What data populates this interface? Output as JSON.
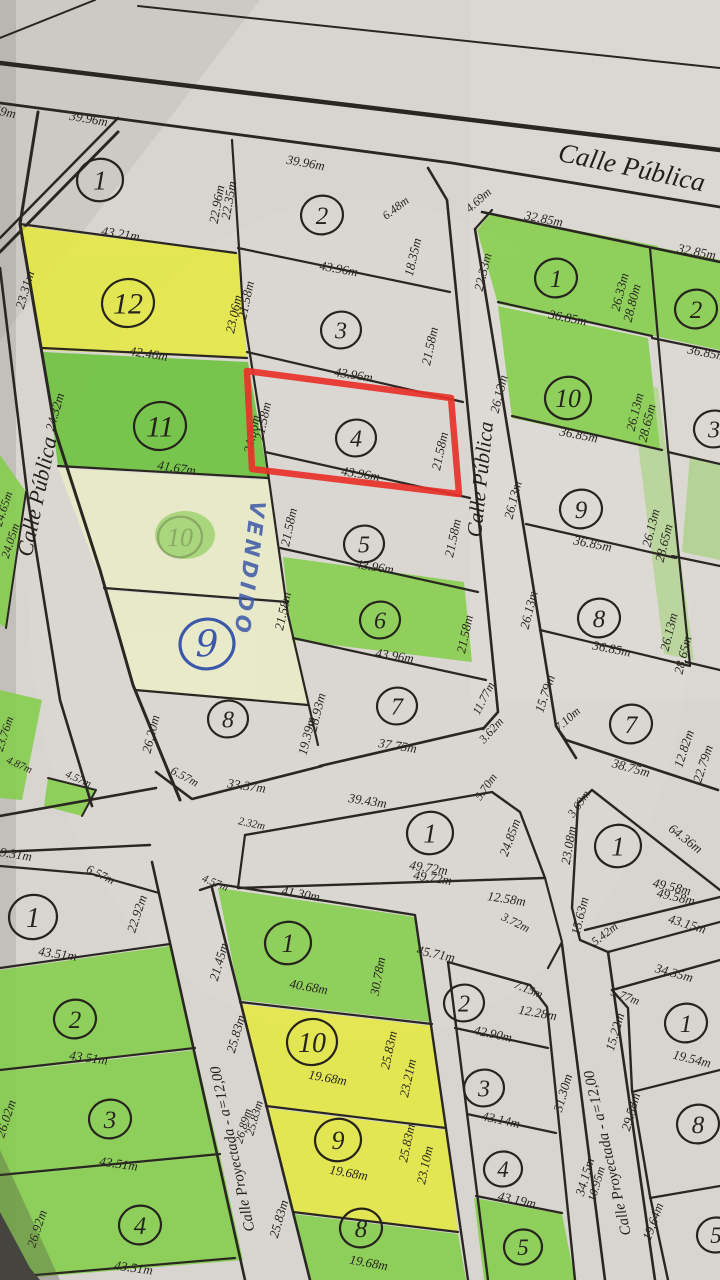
{
  "colors": {
    "paper": "#d8d5d0",
    "ink": "#28251f",
    "highlight_green": "#82ce47",
    "highlight_green_dark": "#68c236",
    "highlight_cream": "#eaedc8",
    "highlight_yellow": "#e6e93e",
    "annotation_red": "#e8322a",
    "handwriting_blue": "#3c58a9"
  },
  "annotations": {
    "vendido": "VENDIDO",
    "selected_lot": "4"
  },
  "streets": [
    [
      "Calle Pública",
      630,
      176,
      12,
      27
    ],
    [
      "Calle Pública",
      44,
      498,
      -78,
      22
    ],
    [
      "Calle Pública",
      487,
      480,
      -84,
      21
    ],
    [
      "Calle Proyectada - a=12,00",
      237,
      1148,
      -102,
      15
    ],
    [
      "Calle Proyectada - a=12,00",
      612,
      1152,
      -103,
      15
    ]
  ],
  "lot_numbers": [
    [
      "1",
      100,
      180,
      23,
      27,
      ""
    ],
    [
      "12",
      128,
      303,
      26,
      30,
      ""
    ],
    [
      "11",
      160,
      426,
      26,
      30,
      ""
    ],
    [
      "10",
      180,
      537,
      22,
      26,
      "faded"
    ],
    [
      "8",
      228,
      719,
      20,
      24,
      ""
    ],
    [
      "2",
      322,
      215,
      21,
      25,
      ""
    ],
    [
      "3",
      341,
      330,
      20,
      24,
      ""
    ],
    [
      "4",
      356,
      438,
      20,
      24,
      ""
    ],
    [
      "5",
      364,
      544,
      20,
      24,
      ""
    ],
    [
      "6",
      380,
      620,
      20,
      24,
      ""
    ],
    [
      "7",
      397,
      706,
      20,
      24,
      ""
    ],
    [
      "1",
      556,
      278,
      21,
      25,
      ""
    ],
    [
      "2",
      696,
      309,
      21,
      25,
      ""
    ],
    [
      "10",
      568,
      398,
      23,
      26,
      ""
    ],
    [
      "9",
      581,
      509,
      21,
      25,
      ""
    ],
    [
      "8",
      599,
      618,
      21,
      25,
      ""
    ],
    [
      "7",
      631,
      724,
      21,
      25,
      ""
    ],
    [
      "3",
      714,
      429,
      20,
      24,
      ""
    ],
    [
      "1",
      430,
      833,
      23,
      27,
      ""
    ],
    [
      "1",
      618,
      846,
      23,
      27,
      ""
    ],
    [
      "1",
      33,
      917,
      24,
      28,
      ""
    ],
    [
      "2",
      75,
      1019,
      21,
      25,
      ""
    ],
    [
      "3",
      110,
      1119,
      21,
      25,
      ""
    ],
    [
      "4",
      140,
      1225,
      21,
      25,
      ""
    ],
    [
      "1",
      288,
      943,
      23,
      26,
      ""
    ],
    [
      "10",
      312,
      1042,
      25,
      28,
      ""
    ],
    [
      "9",
      338,
      1140,
      23,
      26,
      ""
    ],
    [
      "8",
      361,
      1228,
      21,
      25,
      ""
    ],
    [
      "2",
      464,
      1003,
      20,
      24,
      ""
    ],
    [
      "3",
      484,
      1088,
      20,
      24,
      ""
    ],
    [
      "4",
      503,
      1169,
      19,
      23,
      ""
    ],
    [
      "5",
      523,
      1247,
      19,
      23,
      ""
    ],
    [
      "1",
      686,
      1023,
      21,
      25,
      ""
    ],
    [
      "8",
      698,
      1124,
      21,
      25,
      ""
    ],
    [
      "5",
      716,
      1235,
      19,
      23,
      ""
    ],
    [
      "9",
      207,
      644,
      27,
      36,
      "hand"
    ]
  ],
  "measurements": [
    [
      "59m",
      4,
      116,
      12
    ],
    [
      "39.96m",
      88,
      123,
      10
    ],
    [
      "39.96m",
      305,
      167,
      10
    ],
    [
      "22.96m",
      221,
      205,
      -80
    ],
    [
      "22.35m",
      233,
      201,
      -80
    ],
    [
      "6.48m",
      398,
      211,
      -38,
      12
    ],
    [
      "18.35m",
      417,
      258,
      -77
    ],
    [
      "43.96m",
      338,
      273,
      10
    ],
    [
      "43.21m",
      120,
      238,
      9
    ],
    [
      "23.31m",
      29,
      291,
      -74
    ],
    [
      "23.06m",
      238,
      315,
      -78
    ],
    [
      "21.58m",
      250,
      301,
      -78
    ],
    [
      "42.46m",
      148,
      358,
      9
    ],
    [
      "24.32m",
      59,
      413,
      -74
    ],
    [
      "41.67m",
      176,
      472,
      9
    ],
    [
      "24.06m",
      256,
      435,
      -78
    ],
    [
      "21.58m",
      267,
      422,
      -78
    ],
    [
      "21.58m",
      293,
      528,
      -78
    ],
    [
      "21.58m",
      287,
      612,
      -78
    ],
    [
      "43.96m",
      353,
      379,
      9
    ],
    [
      "21.58m",
      434,
      347,
      -78
    ],
    [
      "43.96m",
      360,
      478,
      9
    ],
    [
      "21.58m",
      444,
      452,
      -78
    ],
    [
      "43.96m",
      374,
      571,
      9
    ],
    [
      "21.58m",
      457,
      539,
      -78
    ],
    [
      "43.96m",
      394,
      660,
      9
    ],
    [
      "21.58m",
      469,
      635,
      -78
    ],
    [
      "26.20m",
      155,
      735,
      -76
    ],
    [
      "6.57m",
      183,
      780,
      28,
      12
    ],
    [
      "33.37m",
      246,
      790,
      8
    ],
    [
      "19.39m",
      311,
      737,
      -76
    ],
    [
      "28.93m",
      321,
      713,
      -76
    ],
    [
      "37.75m",
      397,
      750,
      9
    ],
    [
      "11.77m",
      487,
      700,
      -63,
      12
    ],
    [
      "3.62m",
      494,
      733,
      -48,
      12
    ],
    [
      "4.69m",
      481,
      203,
      -42,
      12
    ],
    [
      "32.85m",
      543,
      223,
      11
    ],
    [
      "22.33m",
      487,
      273,
      -76
    ],
    [
      "36.85m",
      567,
      322,
      11
    ],
    [
      "26.33m",
      624,
      293,
      -76
    ],
    [
      "28.80m",
      636,
      304,
      -76
    ],
    [
      "32.85m",
      696,
      256,
      11
    ],
    [
      "36.85m",
      706,
      357,
      11
    ],
    [
      "26.13m",
      503,
      395,
      -76
    ],
    [
      "36.85m",
      578,
      439,
      11
    ],
    [
      "26.13m",
      639,
      413,
      -76
    ],
    [
      "28.65m",
      651,
      424,
      -76
    ],
    [
      "26.13m",
      517,
      501,
      -76
    ],
    [
      "36.85m",
      592,
      548,
      11
    ],
    [
      "26.13m",
      655,
      529,
      -76
    ],
    [
      "28.65m",
      668,
      544,
      -76
    ],
    [
      "26.13m",
      533,
      611,
      -76
    ],
    [
      "36.85m",
      611,
      653,
      11
    ],
    [
      "26.13m",
      673,
      633,
      -76
    ],
    [
      "28.65m",
      687,
      656,
      -76
    ],
    [
      "15.79m",
      549,
      695,
      -72
    ],
    [
      "7.10m",
      570,
      722,
      -42,
      12
    ],
    [
      "38.75m",
      630,
      772,
      15
    ],
    [
      "12.82m",
      688,
      750,
      -72
    ],
    [
      "22.79m",
      707,
      765,
      -72
    ],
    [
      "39.43m",
      367,
      805,
      9
    ],
    [
      "2.32m",
      251,
      827,
      12,
      11
    ],
    [
      "49.72m",
      428,
      872,
      9
    ],
    [
      "49.72m",
      432,
      882,
      9
    ],
    [
      "5.70m",
      489,
      789,
      -55,
      12
    ],
    [
      "24.85m",
      514,
      839,
      -70
    ],
    [
      "12.58m",
      506,
      903,
      9
    ],
    [
      "3.72m",
      514,
      926,
      26,
      12
    ],
    [
      "45.71m",
      435,
      958,
      12
    ],
    [
      "7.15m",
      527,
      993,
      22,
      12
    ],
    [
      "12.28m",
      537,
      1017,
      10
    ],
    [
      "42.90m",
      492,
      1038,
      12
    ],
    [
      "43.14m",
      500,
      1124,
      12
    ],
    [
      "43.19m",
      516,
      1204,
      12
    ],
    [
      "3.69m",
      582,
      806,
      -55,
      12
    ],
    [
      "23.08m",
      573,
      846,
      -80
    ],
    [
      "64.36m",
      683,
      842,
      38
    ],
    [
      "49.58m",
      671,
      891,
      13
    ],
    [
      "49.58m",
      675,
      901,
      13
    ],
    [
      "15.63m",
      584,
      917,
      -76
    ],
    [
      "5.42m",
      607,
      937,
      -38,
      12
    ],
    [
      "43.15m",
      686,
      928,
      17
    ],
    [
      "34.35m",
      673,
      977,
      15
    ],
    [
      "5.77m",
      624,
      1000,
      20,
      12
    ],
    [
      "15.22m",
      619,
      1033,
      -74
    ],
    [
      "19.54m",
      691,
      1063,
      14
    ],
    [
      "29.58m",
      635,
      1113,
      -74
    ],
    [
      "31.30m",
      567,
      1094,
      -74
    ],
    [
      "34.15m",
      589,
      1178,
      -74
    ],
    [
      "10.95m",
      600,
      1185,
      -74,
      12
    ],
    [
      "19.64m",
      657,
      1223,
      -70
    ],
    [
      "29.31m",
      12,
      858,
      9
    ],
    [
      "6.57m",
      99,
      878,
      26,
      12
    ],
    [
      "22.92m",
      141,
      915,
      -72
    ],
    [
      "43.51m",
      57,
      958,
      8
    ],
    [
      "43.51m",
      88,
      1062,
      8
    ],
    [
      "43.51m",
      118,
      1168,
      8
    ],
    [
      "43.51m",
      133,
      1272,
      8
    ],
    [
      "26.02m",
      10,
      1120,
      -72
    ],
    [
      "26.92m",
      41,
      1230,
      -72
    ],
    [
      "23.76m",
      8,
      735,
      -72,
      12
    ],
    [
      "4.87m",
      18,
      768,
      24,
      11
    ],
    [
      "24.65m",
      7,
      510,
      -72,
      12
    ],
    [
      "24.05m",
      14,
      542,
      -72,
      12
    ],
    [
      "4.57m",
      77,
      782,
      24,
      11
    ],
    [
      "4.57m",
      214,
      886,
      22,
      11
    ],
    [
      "41.30m",
      300,
      898,
      10
    ],
    [
      "21.45m",
      223,
      963,
      -74
    ],
    [
      "40.68m",
      308,
      991,
      10
    ],
    [
      "30.78m",
      382,
      977,
      -80
    ],
    [
      "25.83m",
      240,
      1035,
      -74
    ],
    [
      "19.68m",
      327,
      1082,
      10
    ],
    [
      "25.83m",
      393,
      1051,
      -78
    ],
    [
      "23.21m",
      412,
      1079,
      -78
    ],
    [
      "26.89m",
      247,
      1127,
      -74,
      12
    ],
    [
      "25.83m",
      258,
      1119,
      -74,
      12
    ],
    [
      "19.68m",
      348,
      1177,
      10
    ],
    [
      "25.83m",
      411,
      1144,
      -78
    ],
    [
      "23.10m",
      429,
      1166,
      -78
    ],
    [
      "25.83m",
      283,
      1220,
      -74
    ],
    [
      "19.68m",
      368,
      1267,
      10
    ]
  ]
}
